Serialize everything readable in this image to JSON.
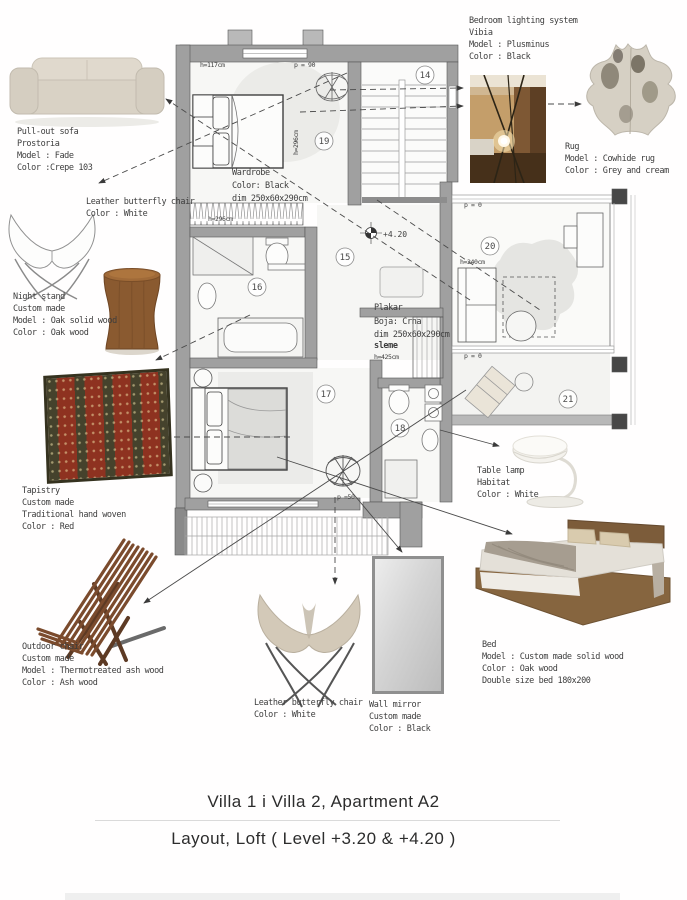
{
  "board": {
    "title_line1": "Villa 1 i Villa 2, Apartment  A2",
    "title_line2": "Layout, Loft  ( Level +3.20 & +4.20 )"
  },
  "items": {
    "pull_out_sofa": {
      "lines": [
        "Pull-out sofa",
        "Prostoria",
        "Model : Fade",
        "Color :Crepe 103"
      ]
    },
    "butterfly_chair_top": {
      "lines": [
        "Leather butterfly chair",
        "Color : White"
      ]
    },
    "night_stand": {
      "lines": [
        "Night stand",
        "Custom made",
        "Model : Oak solid wood",
        "Color : Oak wood"
      ]
    },
    "tapistry": {
      "lines": [
        "Tapistry",
        "Custom made",
        "Traditional hand woven",
        "Color : Red"
      ]
    },
    "outdoor_chair": {
      "lines": [
        "Outdoor chair",
        "Custom made",
        "Model : Thermotreated ash wood",
        "Color : Ash wood"
      ]
    },
    "butterfly_chair_bottom": {
      "lines": [
        "Leather butterfly chair",
        "Color : White"
      ]
    },
    "wall_mirror": {
      "lines": [
        "Wall mirror",
        "Custom made",
        "Color : Black"
      ]
    },
    "bed": {
      "lines": [
        "Bed",
        "Model : Custom made solid wood",
        "Color : Oak wood",
        "Double size bed 180x200"
      ]
    },
    "table_lamp": {
      "lines": [
        "Table lamp",
        "Habitat",
        "Color : White"
      ]
    },
    "lighting_system": {
      "lines": [
        "Bedroom lighting system",
        "Vibia",
        "Model : Plusminus",
        "Color : Black"
      ]
    },
    "rug": {
      "lines": [
        "Rug",
        "Model : Cowhide rug",
        "Color : Grey and cream"
      ]
    }
  },
  "plan": {
    "rooms": {
      "r14": "14",
      "r15": "15",
      "r16": "16",
      "r17": "17",
      "r18": "18",
      "r19": "19",
      "r20": "20",
      "r21": "21"
    },
    "level": "+4.20",
    "wardrobe": {
      "lines": [
        "Wardrobe",
        "Color: Black",
        "dim 250x60x290cm"
      ]
    },
    "plakar": {
      "lines": [
        "Plakar",
        "Boja: Crna",
        "dim 250x60x290cm",
        "sleme",
        "h=425cm"
      ]
    },
    "dims": {
      "h117": "h=117cm",
      "p90": "p = 90",
      "h296_strip": "h=296cm",
      "h296_vert": "h=296cm",
      "h240": "h=240cm",
      "p0_top": "p = 0",
      "p0_bottom": "p = 0",
      "p50": "p =50"
    }
  },
  "colors": {
    "wall_grey": "#a0a0a0",
    "tapestry_red": "#8e3220",
    "oak_wood": "#8a5a30",
    "sofa_beige": "#d9d2c5",
    "leader_line": "#4a4a4a"
  }
}
